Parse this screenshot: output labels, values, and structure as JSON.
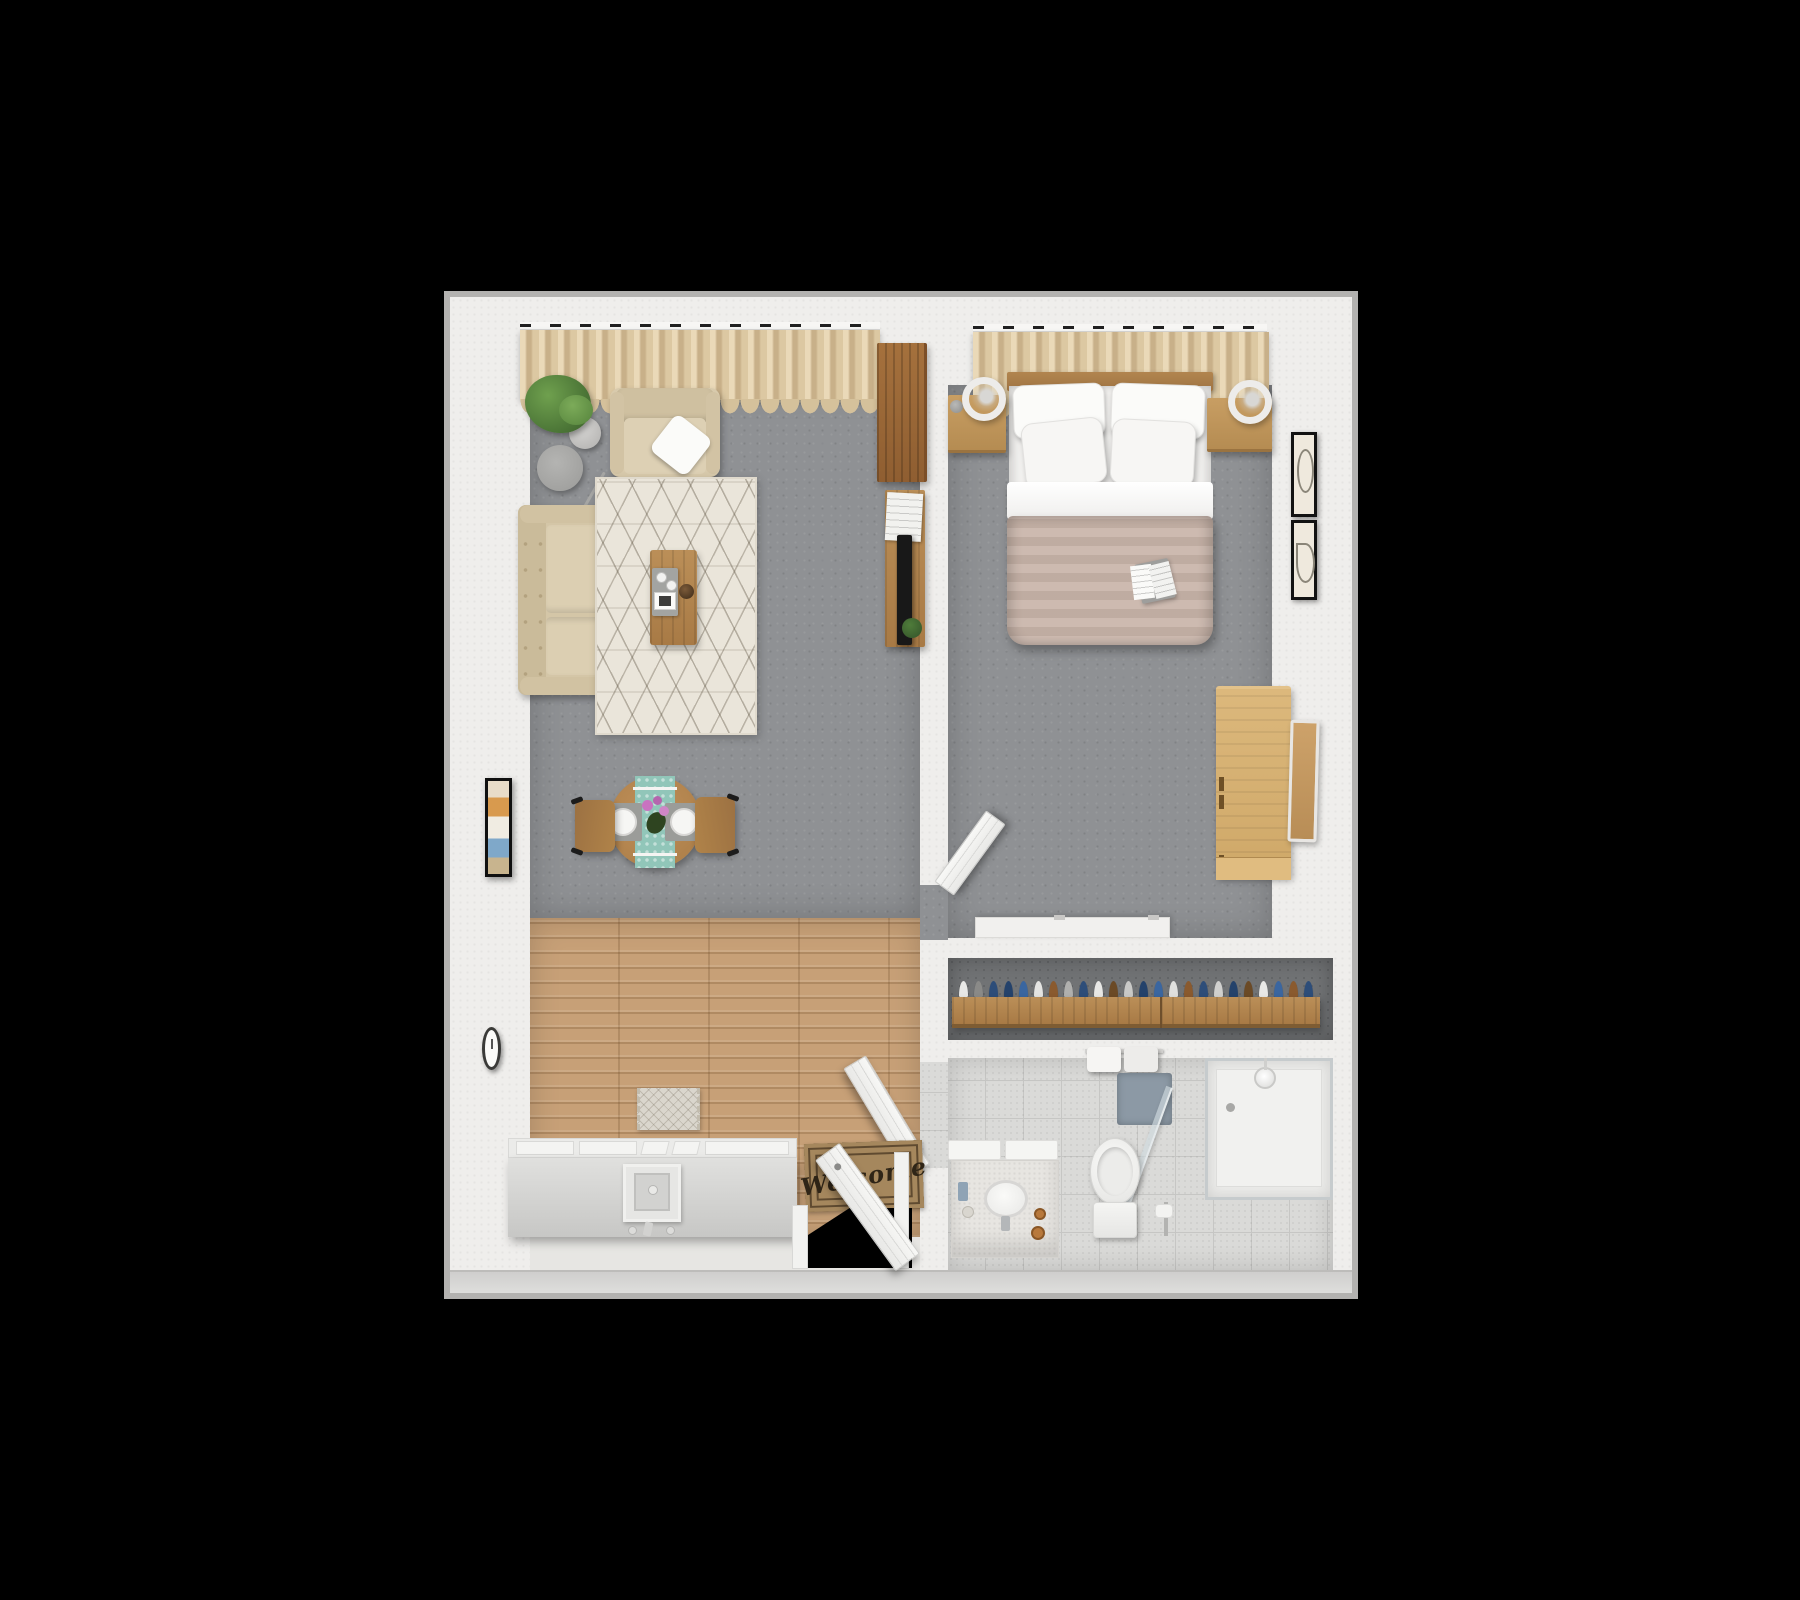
{
  "meta": {
    "description": "3D top-down rendered floor plan of a one-bedroom apartment on a black background",
    "view": "top-down 3D render",
    "background": "#000000"
  },
  "entry": {
    "welcome_mat_text": "Welcome"
  },
  "palette": {
    "wall_white": "#efeeec",
    "wall_edge_grey": "#b3b2b0",
    "carpet_grey": "#8f9194",
    "closet_floor_grey": "#717375",
    "wood_floor": "#c7a077",
    "tile_floor": "#dadad8",
    "curtain_beige": "#dcc8a2",
    "sofa_beige": "#d9cbae",
    "rug_cream": "#eae5da",
    "duvet_taupe": "#c9b5aa",
    "oak_medium": "#b5854e",
    "oak_dark": "#9c6a39",
    "oak_pale": "#d7b073",
    "runner_teal": "#91c6b9",
    "bath_mat_blue": "#8c99a5",
    "mat_brown": "#a5875d",
    "candle_amber": "#b8793c",
    "art_orange": "#d89a4e",
    "art_blue": "#7fa8c9"
  },
  "rooms": {
    "living_room": {
      "name": "Living room",
      "furniture": [
        "window curtains",
        "potted plant",
        "armchair with throw pillow",
        "arc floor lamp with drum shade",
        "side table",
        "loveseat sofa",
        "berber area rug",
        "coffee table with tray, cups, bowl and tablet",
        "round dining table with runner, plates and flowers",
        "two dining chairs",
        "wall art",
        "wall clock",
        "media console with TV and magazines",
        "tall wooden cabinet"
      ]
    },
    "bedroom": {
      "name": "Bedroom",
      "furniture": [
        "window curtains",
        "double bed with four pillows and duvet",
        "open magazine on bed",
        "left nightstand with ring lamp and alarm clock",
        "right nightstand with ring lamp",
        "white wall shelf",
        "pale wood dresser",
        "leaning mirror",
        "two framed wall prints"
      ]
    },
    "closet": {
      "name": "Closet",
      "furniture": [
        "wooden clothes rail",
        "hanging clothes"
      ]
    },
    "bathroom": {
      "name": "Bathroom",
      "furniture": [
        "vanity with sink, faucet and candles",
        "toilet with tank",
        "toilet paper holder",
        "bath mat",
        "towel bar with towels",
        "walk-in glass shower with shower head and drain",
        "open glass shower door"
      ]
    },
    "kitchen_hall": {
      "name": "Kitchen and hallway",
      "furniture": [
        "kitchen counter with cabinet panels",
        "oven-sink unit with faucet and knobs",
        "kitchen mat",
        "welcome mat",
        "open entry door",
        "bedroom door",
        "bathroom door"
      ]
    }
  },
  "closet_hangers": [
    "#e8e8e6",
    "#8a8a88",
    "#2d4d79",
    "#24426b",
    "#3a66a0",
    "#e4e4e2",
    "#8a5a2e",
    "#b0b0ae",
    "#2d4d79",
    "#e8e8e6",
    "#6b4a26",
    "#c9c9c7",
    "#24426b",
    "#3a66a0",
    "#e0e0de",
    "#8a5a2e",
    "#2d4d79",
    "#d0d0ce",
    "#24426b",
    "#6b4a26",
    "#e8e8e6",
    "#3a66a0",
    "#8a5a2e",
    "#2d4d79"
  ]
}
